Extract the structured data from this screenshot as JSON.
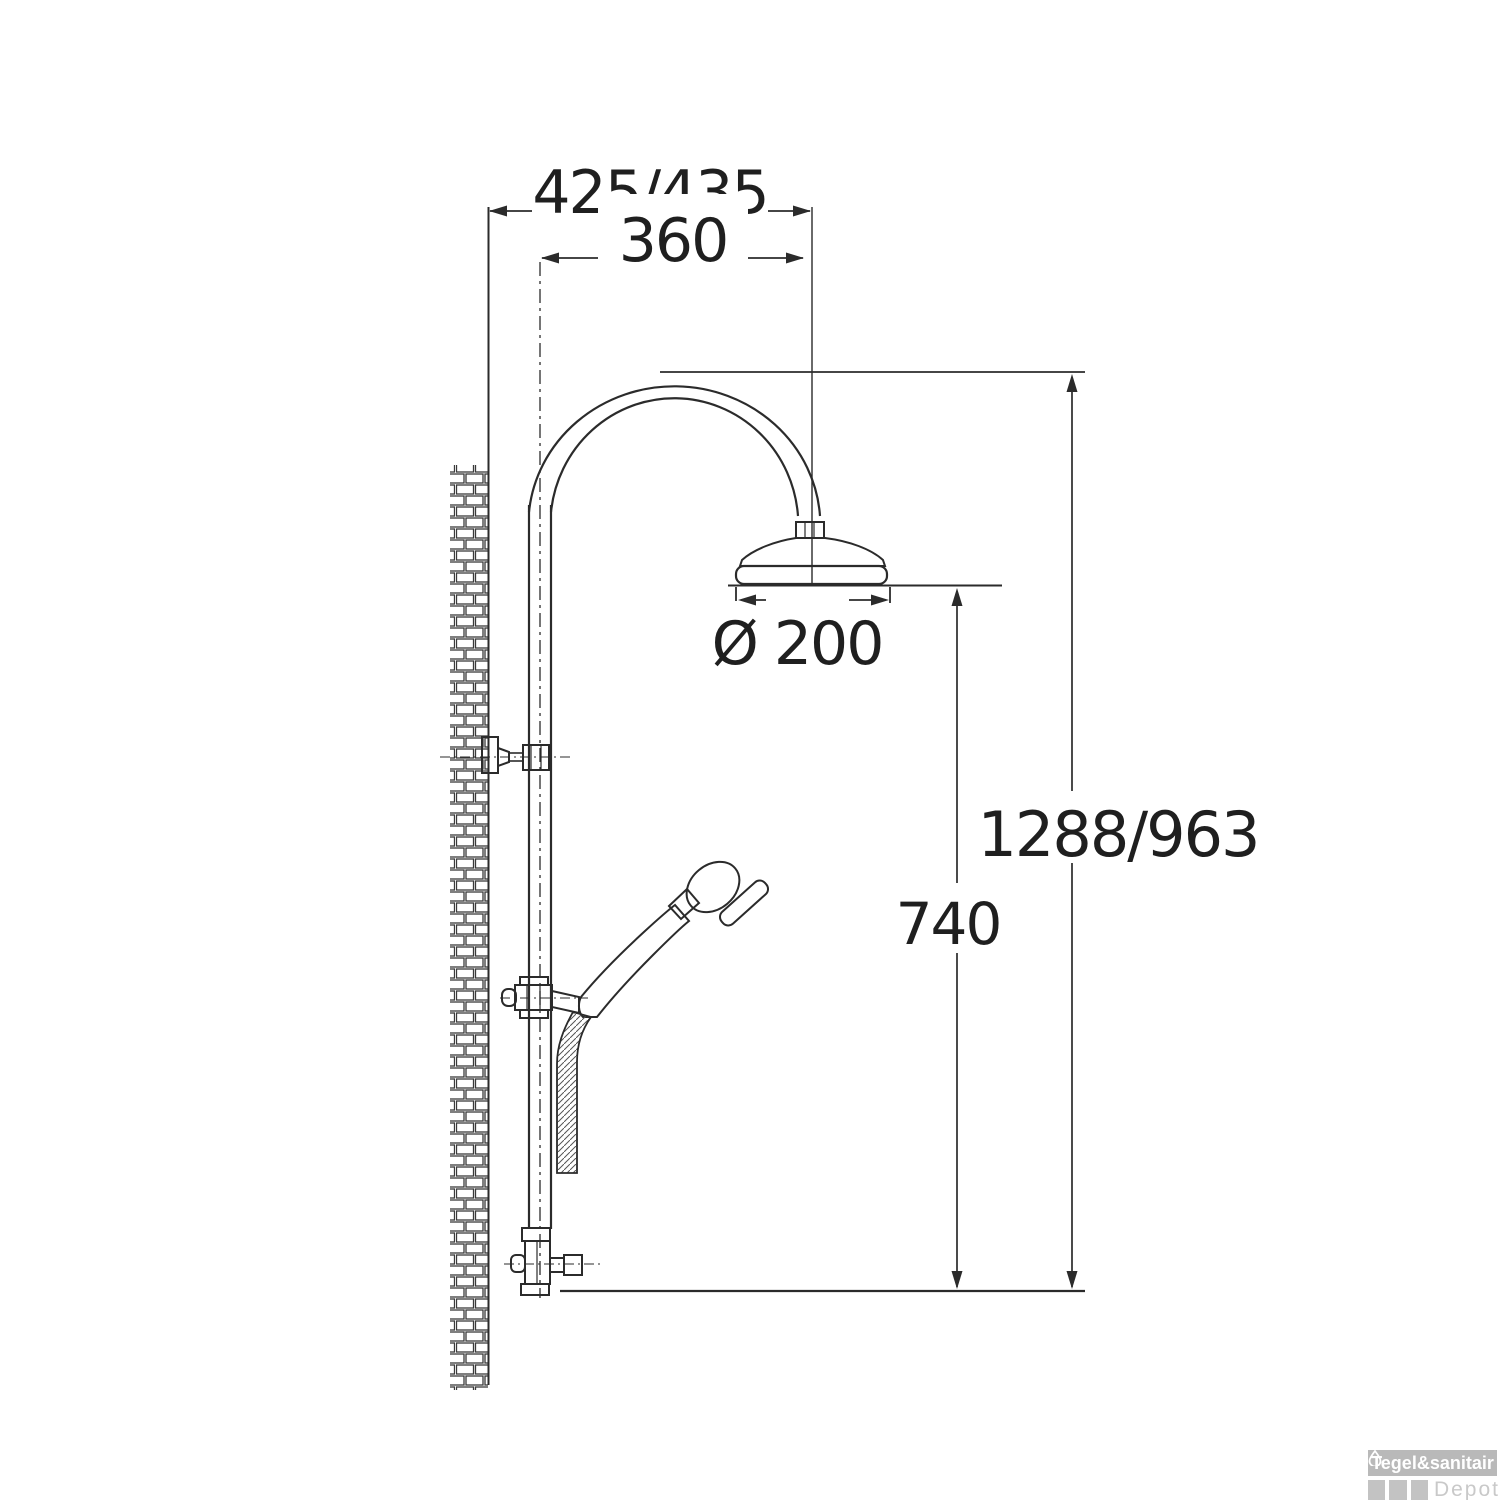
{
  "page": {
    "background": "#ffffff"
  },
  "drawing": {
    "type": "technical-dimension-drawing",
    "subject": "shower column with rain shower head and hand shower",
    "line_color": "#262626",
    "dimensions": {
      "wall_to_head": "425/435",
      "arm_reach": "360",
      "head_diameter": "Ø 200",
      "column_height": "1288/963",
      "head_to_valve": "740"
    }
  },
  "watermark": {
    "brand": "Tegel&sanitair",
    "sub_brand": "Depot",
    "icon": "water-drop-icon",
    "box_color": "#b9b9b9",
    "tile_color": "#c3c3c3",
    "brand_text_color": "#ffffff",
    "sub_text_color": "#c9c9c9"
  }
}
